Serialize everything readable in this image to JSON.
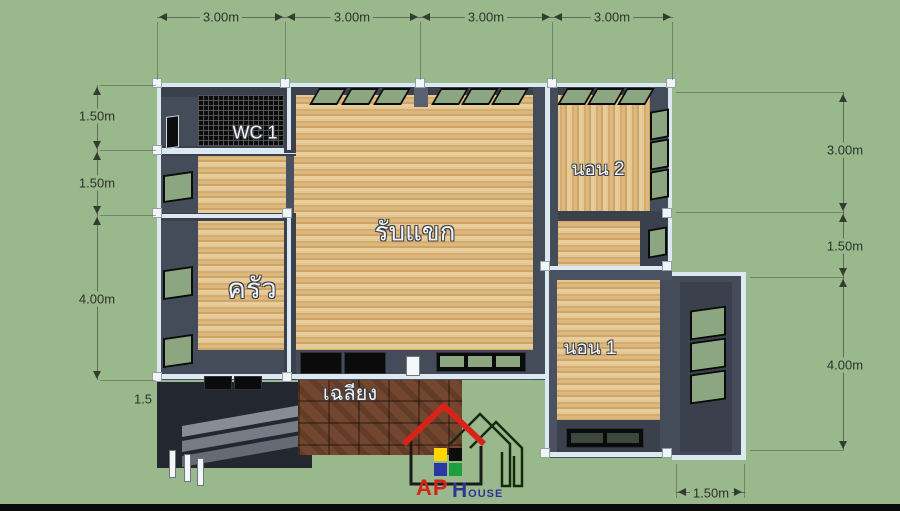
{
  "rooms": {
    "wc": "WC 1",
    "bedroom2": "นอน 2",
    "living": "รับแขก",
    "kitchen": "ครัว",
    "bedroom1": "นอน 1",
    "porch": "เฉลียง"
  },
  "dims": {
    "top": [
      "3.00m",
      "3.00m",
      "3.00m",
      "3.00m"
    ],
    "left": [
      "1.50m",
      "1.50m",
      "4.00m"
    ],
    "left_partial": "1.5",
    "right": [
      "3.00m",
      "1.50m",
      "4.00m"
    ],
    "bottom_right": "1.50m"
  },
  "logo": {
    "brand": "AP",
    "brand2": "House"
  },
  "colors": {
    "background": "#99b98d",
    "wall": "#4a5160",
    "wall_trim": "#dde9f1",
    "wood_floor": "#d7b37a",
    "wc_tile": "#0c0c0c",
    "window_glass": "#8ca682",
    "porch_brick": "#73462f",
    "roof_red": "#d8231b",
    "logo_blue": "#2a3596",
    "logo_squares": [
      "#ffd800",
      "#0d0d0d",
      "#2b37a5",
      "#1e9e3e"
    ]
  }
}
